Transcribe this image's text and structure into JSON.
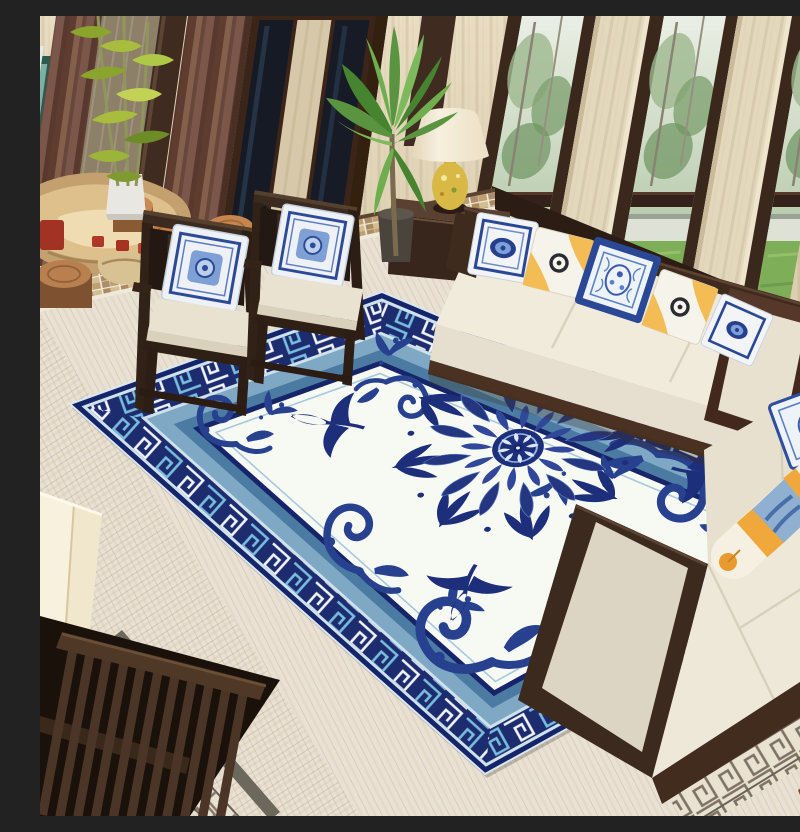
{
  "scene": {
    "title": "New Chinese style living room with blue and white porcelain medallion area rug",
    "room_type": "living room",
    "style": "modern Chinese (Chinoiserie)",
    "no_visible_text": true
  },
  "palette": {
    "rug_navy": "#16246a",
    "rug_band_navy": "#1d2c6e",
    "rug_pale": "#cfe2ec",
    "rug_light": "#7fa8c4",
    "rug_steel": "#4b7ba3",
    "rug_field": "#f7faf3",
    "motif_navy": "#27418f",
    "wall_beige": "#e4d8bc",
    "wood_dark": "#3b281c",
    "curtain_brown": "#74503f",
    "floor_cream": "#e9e1d3",
    "lawn_green": "#7fae58",
    "foliage_green": "#5a9440",
    "cushion_cream": "#efe9db",
    "pillow_yellow": "#f3bc54",
    "lamp_gold": "#d9b945",
    "stump_wood": "#c08050",
    "mosaic_tan": "#c9ad7f",
    "inlay_gray": "#6b685c"
  },
  "rug": {
    "field_color_name": "ivory white",
    "border_pattern": "wan (swastika-fret) meander, alternating white and sky blue on navy",
    "inner_bands": [
      "pale blue outline",
      "light blue band",
      "steel blue band",
      "navy line"
    ],
    "center": "large navy floral medallion rosette with palm sprays",
    "corner_ornaments": "indigo scroll waves"
  },
  "furniture": {
    "chairs": {
      "count": 2,
      "label": "dark wood armchairs with cream cushions and blue-white porcelain pillows"
    },
    "sofa_main": {
      "label": "three-seat cream sofa with dark wood frame",
      "pillows": [
        "blue-white medallion pillow",
        "yellow-corner ring pillow",
        "blue porcelain pillow",
        "yellow-corner ring pillow",
        "blue-white medallion pillow"
      ]
    },
    "sofa_right": {
      "label": "cream chaise sofa with wood frame",
      "accessories": [
        "blue-white pillow",
        "yellow-and-blue bolster"
      ]
    },
    "nightstand": {
      "label": "dark wood side table with drawer and brass knob"
    },
    "lamps": {
      "count": 2,
      "label": "cream bell shades with gold ceramic vase bases"
    },
    "tea_table": {
      "label": "natural driftwood root tea table with red tea set"
    },
    "stump_stools": {
      "count": 4
    },
    "screen_bench": {
      "label": "dark wood slatted bench, bottom left"
    }
  },
  "plants": [
    {
      "name": "bamboo",
      "container": "white planter box"
    },
    {
      "name": "palm",
      "container": "dark pot"
    }
  ],
  "architecture": {
    "windows": "floor-to-ceiling dark wood framed windows with beige stone pillars",
    "outside_view": "trees, white garden wall, green lawn",
    "curtains": "brown drapes",
    "floor": "cream travertine with gray stripe and Greek-key inlay borders, mosaic wall border"
  }
}
